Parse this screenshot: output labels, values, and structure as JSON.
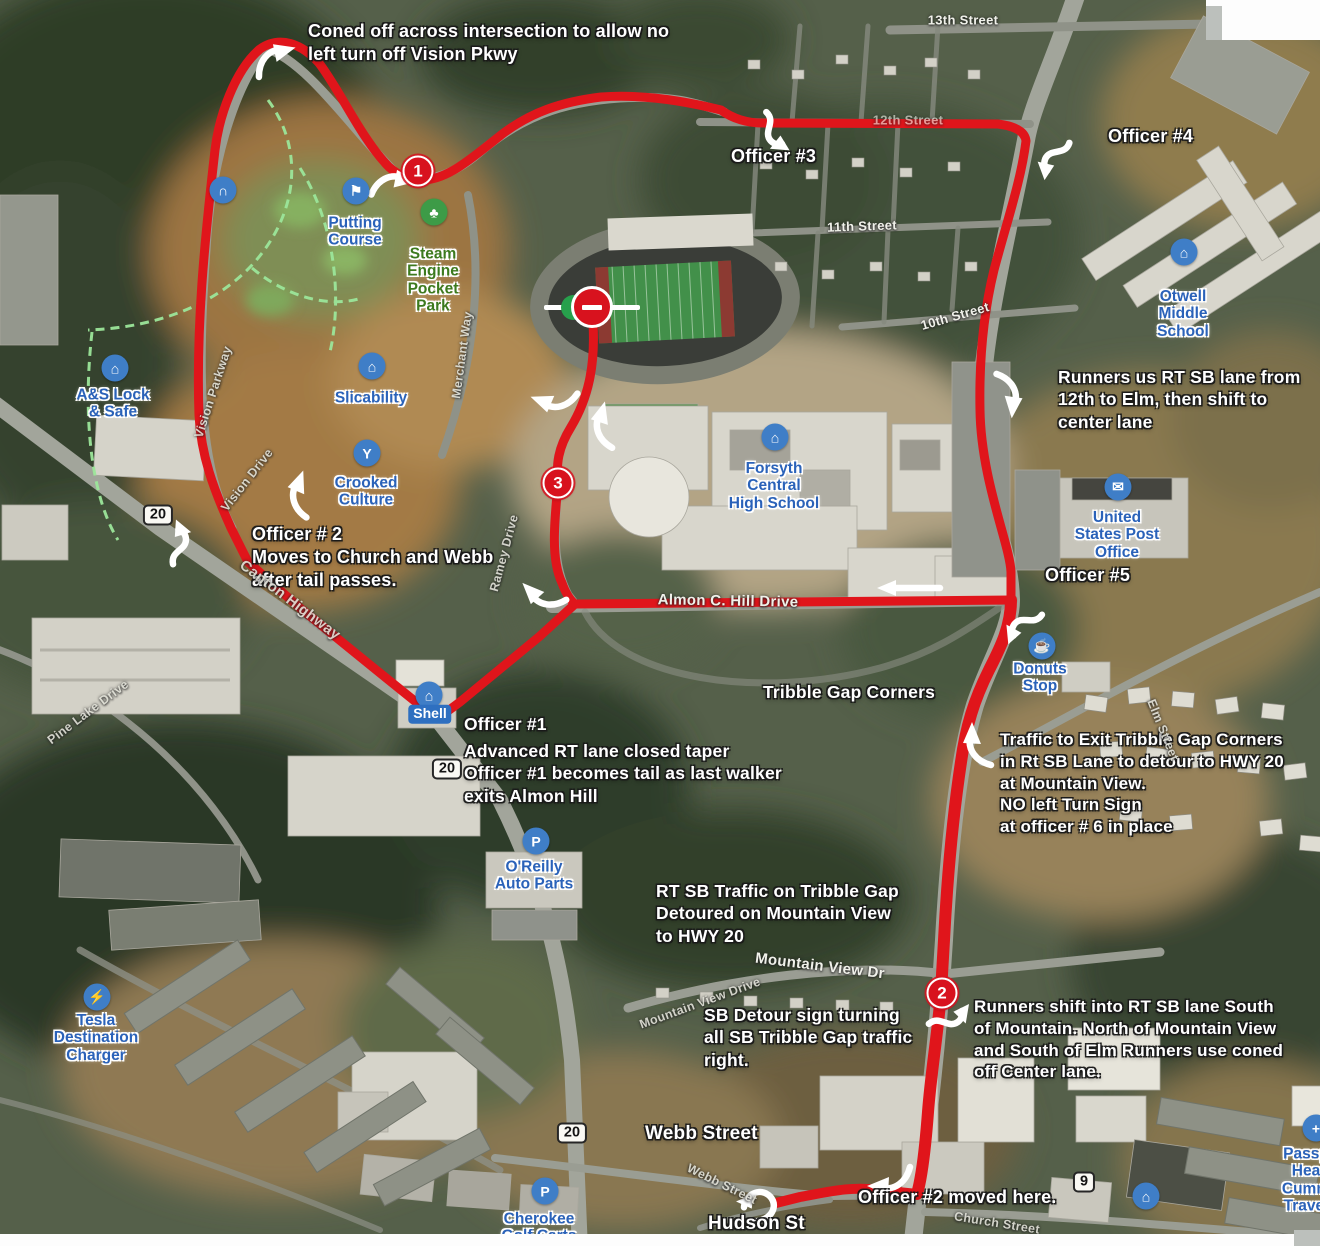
{
  "map": {
    "title": "Race course traffic control map",
    "route": {
      "color": "#e0151b",
      "segments": [
        {
          "d": "M575,604 L540,636 L460,702 L437,719 L380,673 L300,608 L248,562 L231,528 C213,488 201,455 199,415 C196,330 204,245 215,150 C219,116 235,70 260,49 C280,35 302,44 319,63 C341,92 362,140 389,167 C399,176 412,181 425,180 C449,178 471,159 501,135 C531,112 561,102 601,97 C641,94 681,100 721,110 C733,119 748,123 762,123 L998,124 C1014,126 1025,131 1026,141 C1021,181 1007,221 994,270 C984,311 979,360 980,410 C981,480 1010,545 1011,572 L1011,600",
          "w": 9
        },
        {
          "d": "M575,604 L1011,600",
          "w": 9
        },
        {
          "d": "M592,310 C597,362 589,397 571,427 C558,448 556,464 558,484 C554,525 551,560 562,583 C566,594 570,600 575,604",
          "w": 9
        },
        {
          "d": "M1011,600 C1011,628 999,650 989,670 C974,700 966,726 961,762 C952,822 947,882 944,940 L941,992 C938,1032 931,1072 928,1112 C925,1152 921,1180 917,1194",
          "w": 12
        },
        {
          "d": "M917,1194 L880,1190 C850,1186 828,1192 800,1197 L776,1203",
          "w": 10
        }
      ]
    },
    "arrows": [
      {
        "x": 272,
        "y": 60,
        "rot": -15,
        "t": "c"
      },
      {
        "x": 390,
        "y": 184,
        "rot": 8,
        "t": "c"
      },
      {
        "x": 770,
        "y": 133,
        "rot": 35,
        "t": "s"
      },
      {
        "x": 1052,
        "y": 155,
        "rot": 100,
        "t": "s"
      },
      {
        "x": 1008,
        "y": 392,
        "rot": 95,
        "t": "c"
      },
      {
        "x": 557,
        "y": 400,
        "rot": -160,
        "t": "c"
      },
      {
        "x": 604,
        "y": 428,
        "rot": -75,
        "t": "c"
      },
      {
        "x": 300,
        "y": 497,
        "rot": -70,
        "t": "c"
      },
      {
        "x": 182,
        "y": 545,
        "rot": -110,
        "t": "s"
      },
      {
        "x": 545,
        "y": 597,
        "rot": -135,
        "t": "c"
      },
      {
        "x": 910,
        "y": 588,
        "rot": 0,
        "t": "st"
      },
      {
        "x": 1022,
        "y": 622,
        "rot": 115,
        "t": "s"
      },
      {
        "x": 978,
        "y": 748,
        "rot": -90,
        "t": "c"
      },
      {
        "x": 950,
        "y": 1022,
        "rot": -50,
        "t": "s"
      },
      {
        "x": 893,
        "y": 1180,
        "rot": 180,
        "t": "c"
      },
      {
        "x": 760,
        "y": 1205,
        "rot": 150,
        "t": "curl"
      }
    ],
    "markers": [
      {
        "number": "1",
        "x": 418,
        "y": 171
      },
      {
        "number": "3",
        "x": 558,
        "y": 483
      },
      {
        "number": "2",
        "x": 942,
        "y": 993
      }
    ],
    "start_marker": {
      "x": 592,
      "y": 307
    },
    "shields": [
      {
        "text": "20",
        "x": 158,
        "y": 515
      },
      {
        "text": "20",
        "x": 447,
        "y": 769
      },
      {
        "text": "20",
        "x": 572,
        "y": 1133
      },
      {
        "text": "9",
        "x": 1084,
        "y": 1182
      }
    ],
    "annotations": [
      {
        "text": "Coned off across intersection to allow no\nleft turn off  Vision Pkwy",
        "x": 308,
        "y": 20,
        "size": 18
      },
      {
        "text": "Officer #3",
        "x": 731,
        "y": 145,
        "size": 18
      },
      {
        "text": "Officer #4",
        "x": 1108,
        "y": 125,
        "size": 18
      },
      {
        "text": "Runners us RT SB lane from\n12th to Elm, then shift to\ncenter lane",
        "x": 1058,
        "y": 366
      },
      {
        "text": "Officer # 2\nMoves to Church and Webb\nafter tail passes.",
        "x": 252,
        "y": 523,
        "size": 18
      },
      {
        "text": "Officer #5",
        "x": 1045,
        "y": 564,
        "size": 18
      },
      {
        "text": "Tribble Gap Corners",
        "x": 763,
        "y": 681
      },
      {
        "text": "Officer #1",
        "x": 464,
        "y": 713
      },
      {
        "text": "Advanced RT lane closed taper\nOfficer #1 becomes tail as last walker\nexits Almon Hill",
        "x": 464,
        "y": 740
      },
      {
        "text": "Traffic to Exit Tribble Gap Corners\nin Rt SB Lane to detour to HWY 20\nat Mountain View.\nNO left Turn Sign\nat officer # 6 in place",
        "x": 1000,
        "y": 729,
        "size": 17
      },
      {
        "text": "RT SB Traffic on Tribble Gap\nDetoured on Mountain View\nto HWY 20",
        "x": 656,
        "y": 880
      },
      {
        "text": "SB Detour sign turning\nall SB Tribble Gap traffic\nright.",
        "x": 704,
        "y": 1004
      },
      {
        "text": "Runners shift into RT SB lane South\nof Mountain. North of Mountain View\nand South of Elm Runners use coned\noff Center lane.",
        "x": 974,
        "y": 996,
        "size": 17
      },
      {
        "text": "Officer #2 moved here.",
        "x": 858,
        "y": 1186,
        "size": 18
      },
      {
        "text": "Webb Street",
        "x": 645,
        "y": 1122,
        "size": 19
      },
      {
        "text": "Hudson St",
        "x": 708,
        "y": 1212,
        "size": 19
      }
    ],
    "street_labels": [
      {
        "text": "13th Street",
        "x": 963,
        "y": 20,
        "rot": 0,
        "style": ""
      },
      {
        "text": "12th Street",
        "x": 908,
        "y": 120,
        "rot": 0,
        "style": "faded"
      },
      {
        "text": "11th Street",
        "x": 862,
        "y": 226,
        "rot": -2,
        "style": ""
      },
      {
        "text": "10th Street",
        "x": 955,
        "y": 316,
        "rot": -16,
        "style": ""
      },
      {
        "text": "Merchant Way",
        "x": 462,
        "y": 355,
        "rot": -82,
        "style": "minor"
      },
      {
        "text": "Ramey Drive",
        "x": 504,
        "y": 553,
        "rot": -75,
        "style": "minor"
      },
      {
        "text": "Vision Parkway",
        "x": 213,
        "y": 392,
        "rot": -72,
        "style": "minor"
      },
      {
        "text": "Vision Drive",
        "x": 247,
        "y": 480,
        "rot": -52,
        "style": "minor"
      },
      {
        "text": "Canton Highway",
        "x": 290,
        "y": 600,
        "rot": 37,
        "style": "minor big"
      },
      {
        "text": "Pine Lake Drive",
        "x": 88,
        "y": 712,
        "rot": -37,
        "style": "minor"
      },
      {
        "text": "Almon C. Hill Drive",
        "x": 728,
        "y": 601,
        "rot": 1,
        "style": "big"
      },
      {
        "text": "Mountain View Dr",
        "x": 820,
        "y": 966,
        "rot": 7,
        "style": "big"
      },
      {
        "text": "Mountain View Drive",
        "x": 700,
        "y": 1003,
        "rot": -20,
        "style": "minor"
      },
      {
        "text": "Elm Street",
        "x": 1163,
        "y": 730,
        "rot": 68,
        "style": "minor"
      },
      {
        "text": "Webb Street",
        "x": 722,
        "y": 1184,
        "rot": 26,
        "style": "minor"
      },
      {
        "text": "Church Street",
        "x": 997,
        "y": 1223,
        "rot": 9,
        "style": "minor"
      }
    ],
    "pois": [
      {
        "label": "Putting\nCourse",
        "icon": "golf-flag-icon",
        "ix": 356,
        "iy": 191,
        "lx": 355,
        "ly": 232
      },
      {
        "label": "Steam\nEngine\nPocket\nPark",
        "icon": "tree-icon",
        "ix": 434,
        "iy": 212,
        "lx": 433,
        "ly": 280,
        "cls": "green",
        "icls": "green"
      },
      {
        "label": "Slicability",
        "icon": "store-icon",
        "ix": 372,
        "iy": 366,
        "lx": 371,
        "ly": 398
      },
      {
        "label": "Crooked\nCulture",
        "icon": "cocktail-icon",
        "ix": 367,
        "iy": 453,
        "lx": 366,
        "ly": 492
      },
      {
        "label": "A&S Lock\n& Safe",
        "icon": "basket-icon",
        "ix": 115,
        "iy": 368,
        "lx": 113,
        "ly": 404
      },
      {
        "label": "Forsyth\nCentral\nHigh School",
        "icon": "school-icon",
        "ix": 775,
        "iy": 437,
        "lx": 774,
        "ly": 486
      },
      {
        "label": "Otwell\nMiddle\nSchool",
        "icon": "school-icon",
        "ix": 1184,
        "iy": 252,
        "lx": 1183,
        "ly": 314
      },
      {
        "label": "United\nStates Post\nOffice",
        "icon": "mail-icon",
        "ix": 1118,
        "iy": 487,
        "lx": 1117,
        "ly": 535
      },
      {
        "label": "Donuts\nStop",
        "icon": "coffee-icon",
        "ix": 1042,
        "iy": 646,
        "lx": 1040,
        "ly": 678
      },
      {
        "label": "Shell",
        "icon": "fuel-icon",
        "ix": 429,
        "iy": 695,
        "lx": 430,
        "ly": 714,
        "cls": "tag"
      },
      {
        "label": "O'Reilly\nAuto Parts",
        "icon": "parking-icon",
        "ix": 536,
        "iy": 841,
        "lx": 534,
        "ly": 876
      },
      {
        "label": "Tesla\nDestination\nCharger",
        "icon": "ev-charger-icon",
        "ix": 97,
        "iy": 997,
        "lx": 96,
        "ly": 1038
      },
      {
        "label": "Cherokee\nGolf Carts",
        "icon": "parking-icon",
        "ix": 545,
        "iy": 1191,
        "lx": 539,
        "ly": 1228
      },
      {
        "label": "Passp\nHea\nCumm\nTravel",
        "icon": "health-icon",
        "ix": 1316,
        "iy": 1128,
        "lx": 1306,
        "ly": 1180
      },
      {
        "label": "",
        "icon": "basket-icon",
        "ix": 1146,
        "iy": 1196
      },
      {
        "label": "",
        "icon": "arch-icon",
        "ix": 223,
        "iy": 190
      }
    ]
  }
}
